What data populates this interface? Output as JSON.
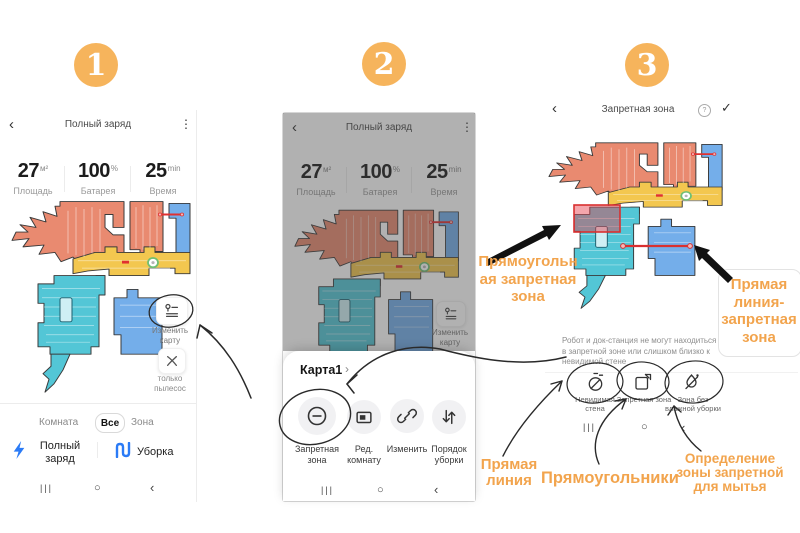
{
  "steps": {
    "s1": "1",
    "s2": "2",
    "s3": "3"
  },
  "colors": {
    "annotation_orange": "#F2A44D",
    "badge_orange": "#F6B45C",
    "action_blue": "#2B7BF6",
    "zone_red": "#E03030",
    "map_coral": "#E98A70",
    "map_yellow": "#F3C74F",
    "map_cyan": "#53C6D6",
    "map_blue": "#74AEEA"
  },
  "phone1": {
    "back_icon": "‹",
    "title": "Полный заряд",
    "menu_icon": "⋮",
    "stats": [
      {
        "value": "27",
        "unit": "м²",
        "label": "Площадь"
      },
      {
        "value": "100",
        "unit": "%",
        "label": "Батарея"
      },
      {
        "value": "25",
        "unit": "min",
        "label": "Время"
      }
    ],
    "edit_map_button": {
      "line1": "Изменить",
      "line2": "карту"
    },
    "vacuum_only_button": {
      "line1": "только",
      "line2": "пылесос"
    },
    "mode_tabs": {
      "room": "Комната",
      "all": "Все",
      "zone": "Зона",
      "selected": "Все"
    },
    "full_charge": {
      "line1": "Полный",
      "line2": "заряд"
    },
    "clean_label": "Уборка"
  },
  "phone2": {
    "sheet": {
      "map_name": "Карта1",
      "chevron": "›",
      "buttons": [
        {
          "line1": "Запретная",
          "line2": "зона"
        },
        {
          "line1": "Ред.",
          "line2": "комнату"
        },
        {
          "line1": "Изменить",
          "line2": ""
        },
        {
          "line1": "Порядок",
          "line2": "уборки"
        }
      ]
    }
  },
  "phone3": {
    "back_icon": "‹",
    "title": "Запретная зона",
    "help_icon": "?",
    "confirm_icon": "✓",
    "info_lines": [
      "Робот и док-станция не могут находиться",
      "в запретной зоне или слишком близко к",
      "невидимой стене"
    ],
    "tools": [
      {
        "line1": "Невидимая",
        "line2": "стена"
      },
      {
        "line1": "Запретная зона",
        "line2": ""
      },
      {
        "line1": "Зона без",
        "line2": "влажной уборки"
      }
    ]
  },
  "nav": {
    "recents": "|||",
    "home": "○",
    "back": "‹"
  },
  "annotations": {
    "rect_zone": [
      "Прямоугольн",
      "ая запретная",
      "зона"
    ],
    "line_zone": [
      "Прямая",
      "линия-",
      "запретная",
      "зона"
    ],
    "straight_line": [
      "Прямая",
      "линия"
    ],
    "rectangles": "Прямоугольники",
    "no_mop_zone": [
      "Определение",
      "зоны запретной",
      "для мытья"
    ]
  }
}
